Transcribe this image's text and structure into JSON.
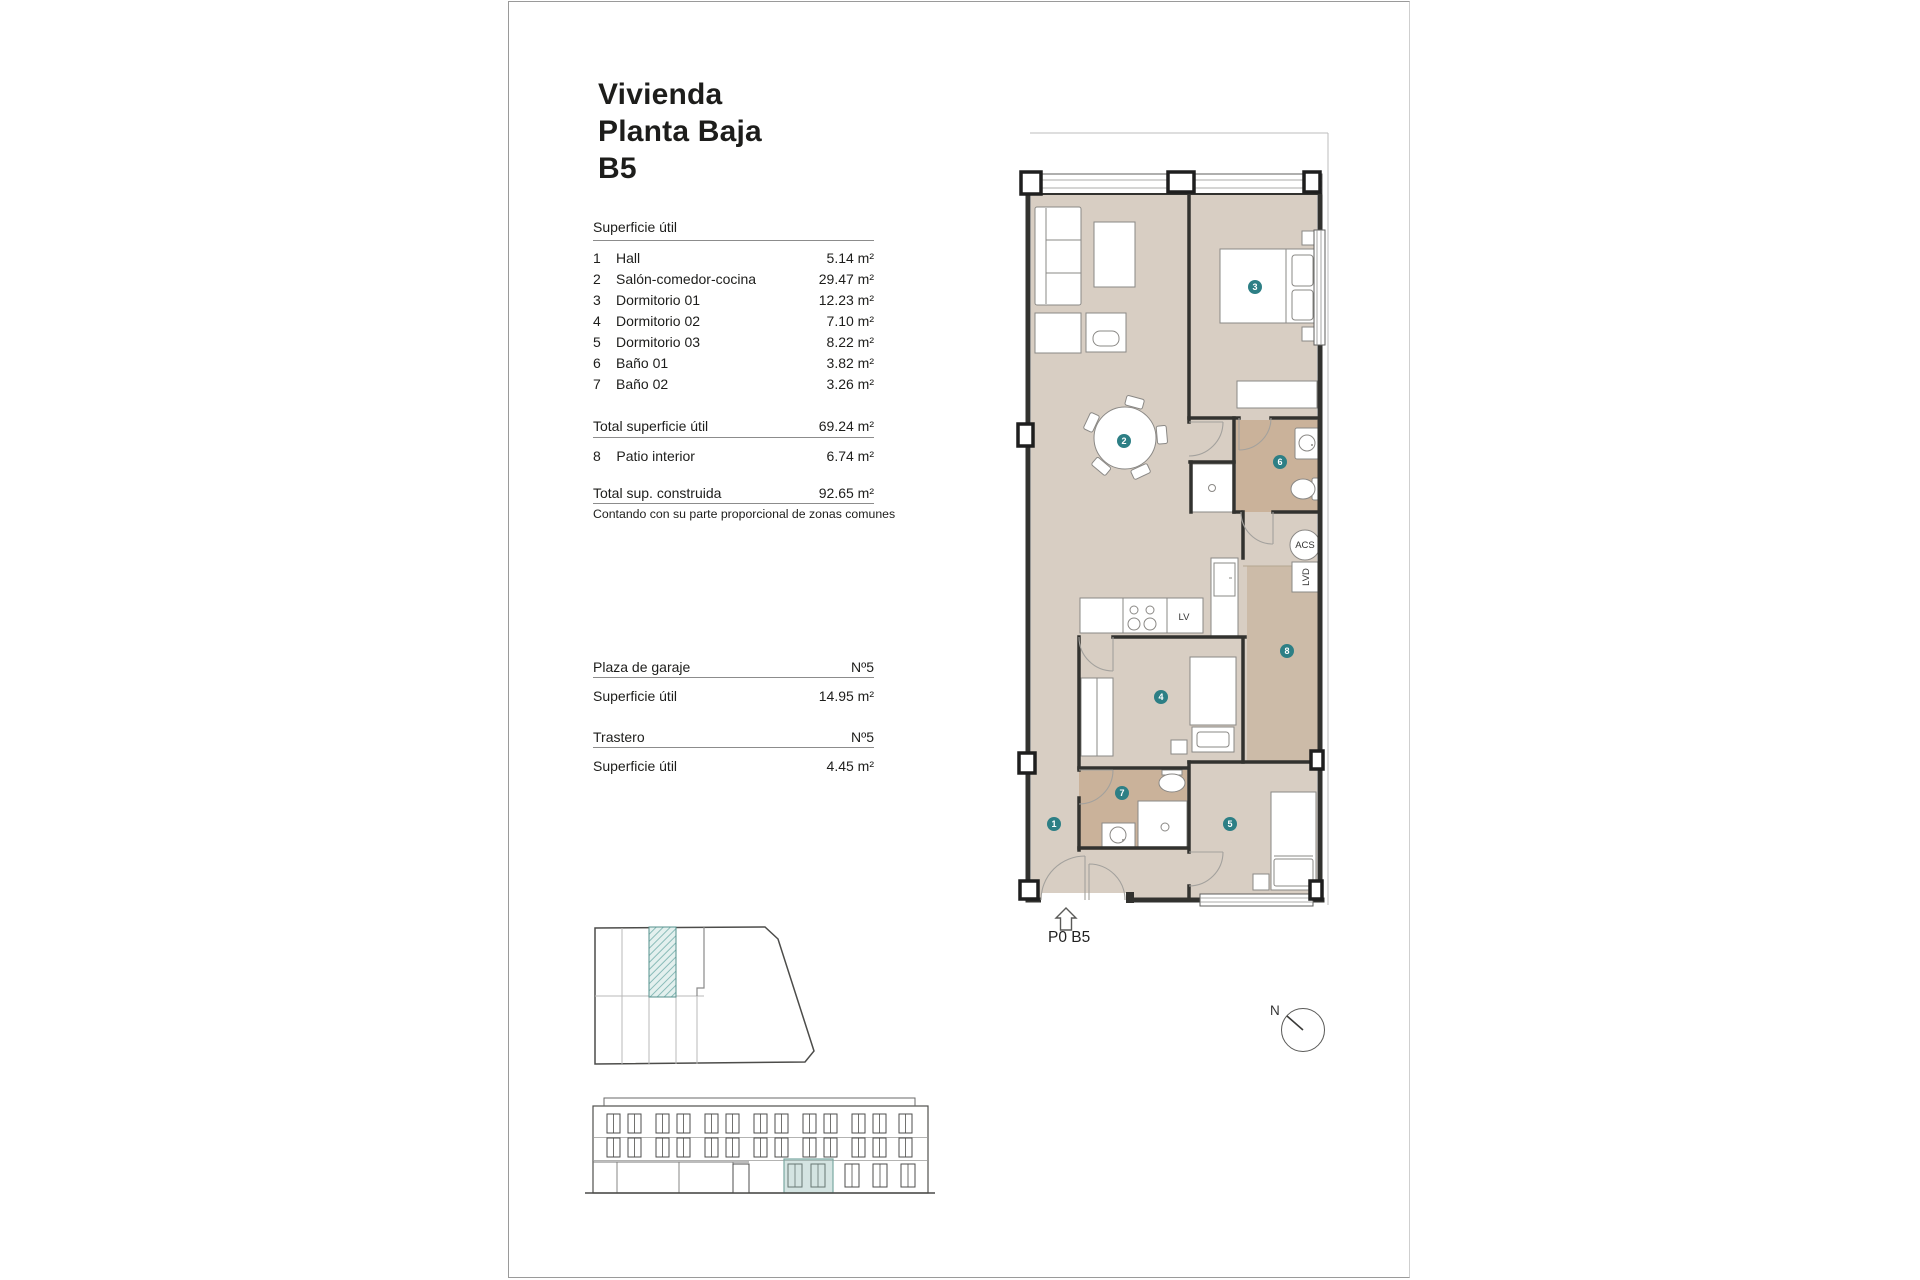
{
  "title": {
    "lines": [
      "Vivienda",
      "Planta Baja",
      "B5"
    ]
  },
  "surface_table": {
    "heading": "Superficie útil",
    "rows": [
      {
        "num": "1",
        "label": "Hall",
        "value": "5.14 m²"
      },
      {
        "num": "2",
        "label": "Salón-comedor-cocina",
        "value": "29.47 m²"
      },
      {
        "num": "3",
        "label": "Dormitorio 01",
        "value": "12.23 m²"
      },
      {
        "num": "4",
        "label": "Dormitorio 02",
        "value": "7.10 m²"
      },
      {
        "num": "5",
        "label": "Dormitorio 03",
        "value": "8.22 m²"
      },
      {
        "num": "6",
        "label": "Baño 01",
        "value": "3.82 m²"
      },
      {
        "num": "7",
        "label": "Baño 02",
        "value": "3.26 m²"
      }
    ],
    "total_useful": {
      "label": "Total superficie útil",
      "value": "69.24 m²"
    },
    "patio_row": {
      "num": "8",
      "label": "Patio interior",
      "value": "6.74 m²"
    },
    "total_built": {
      "label": "Total sup. construida",
      "value": "92.65 m²"
    },
    "note": "Contando con su parte proporcional de zonas comunes"
  },
  "garage": {
    "label": "Plaza de garaje",
    "number": "Nº5",
    "area_label": "Superficie útil",
    "area_value": "14.95 m²"
  },
  "storage": {
    "label": "Trastero",
    "number": "Nº5",
    "area_label": "Superficie útil",
    "area_value": "4.45 m²"
  },
  "plan": {
    "floor_label": "P0 B5",
    "room_numbers": [
      "1",
      "2",
      "3",
      "4",
      "5",
      "6",
      "7",
      "8"
    ],
    "equipment_labels": {
      "acs": "ACS",
      "lvd": "LVD",
      "dishwasher": "LV"
    },
    "colors": {
      "floor": "#d8cec3",
      "wet_floor": "#cab29a",
      "patio_floor": "#ccbba8",
      "marker": "#2d7f85",
      "wall": "#32322f",
      "highlight": "#7aa8a2"
    }
  },
  "compass": {
    "north_label": "N"
  }
}
